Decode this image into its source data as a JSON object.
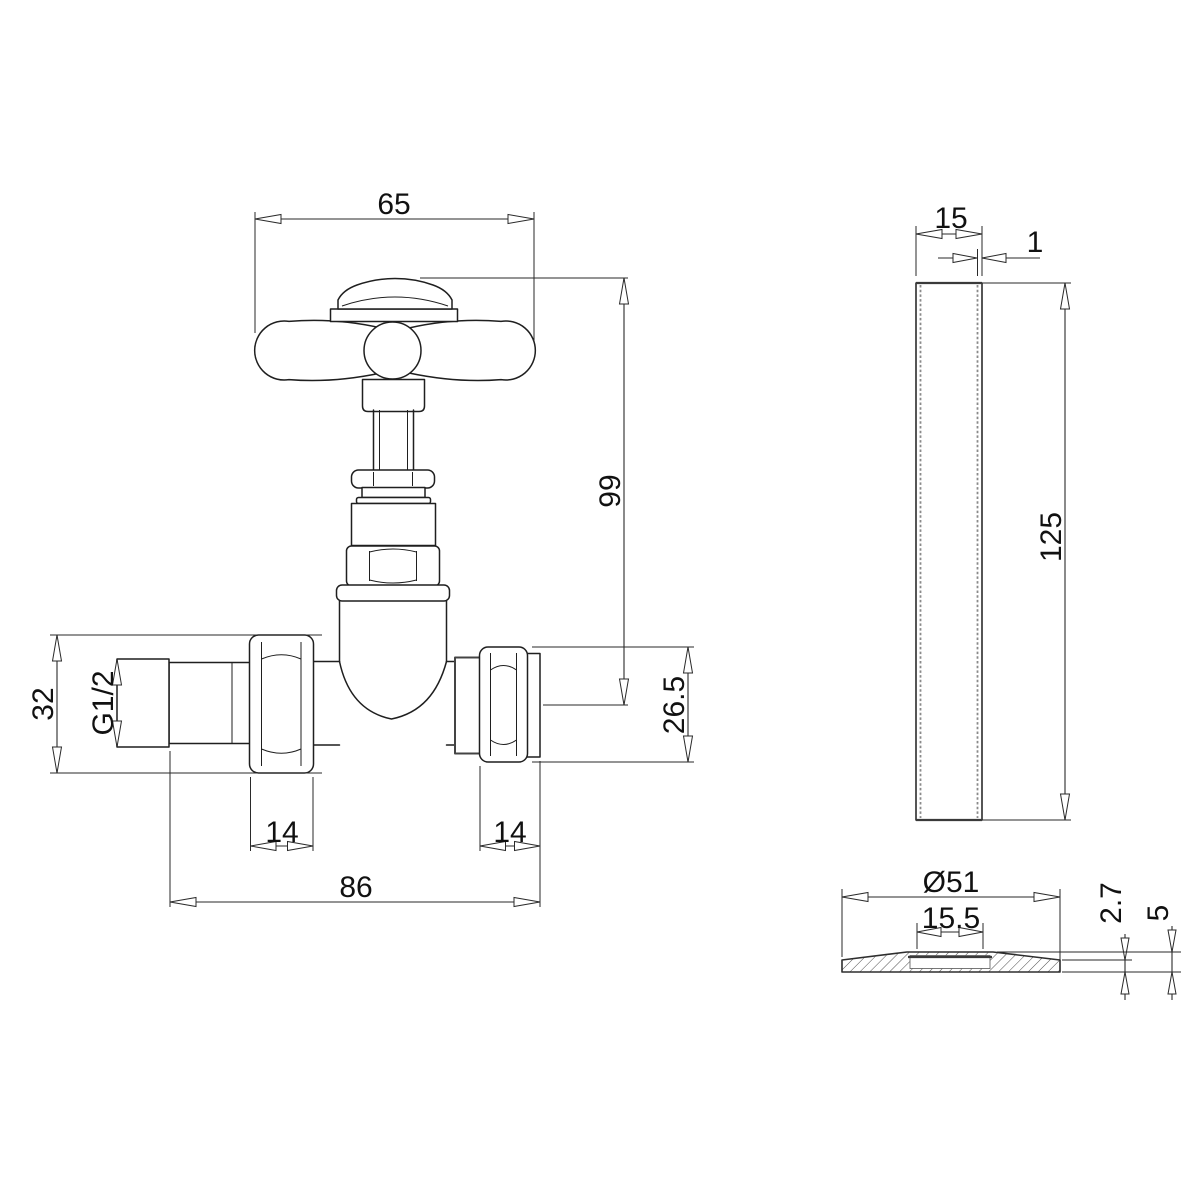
{
  "colors": {
    "background": "#ffffff",
    "line": "#1f1f1f",
    "dim": "#2a2a2a",
    "text": "#111111",
    "wall": "#8a8a8a"
  },
  "valve_front_view": {
    "handle_width": "65",
    "height_to_handle": "99",
    "inlet_nut_height": "32",
    "thread_size": "G1/2",
    "left_nut_width": "14",
    "right_nut_width": "14",
    "overall_length": "86",
    "outlet_height": "26.5"
  },
  "pipe_side_view": {
    "outer_diameter": "15",
    "wall_thickness": "1",
    "length": "125"
  },
  "collar_section_view": {
    "outer_diameter": "Ø51",
    "bore": "15.5",
    "rim_thickness": "2.7",
    "overall_height": "5"
  }
}
